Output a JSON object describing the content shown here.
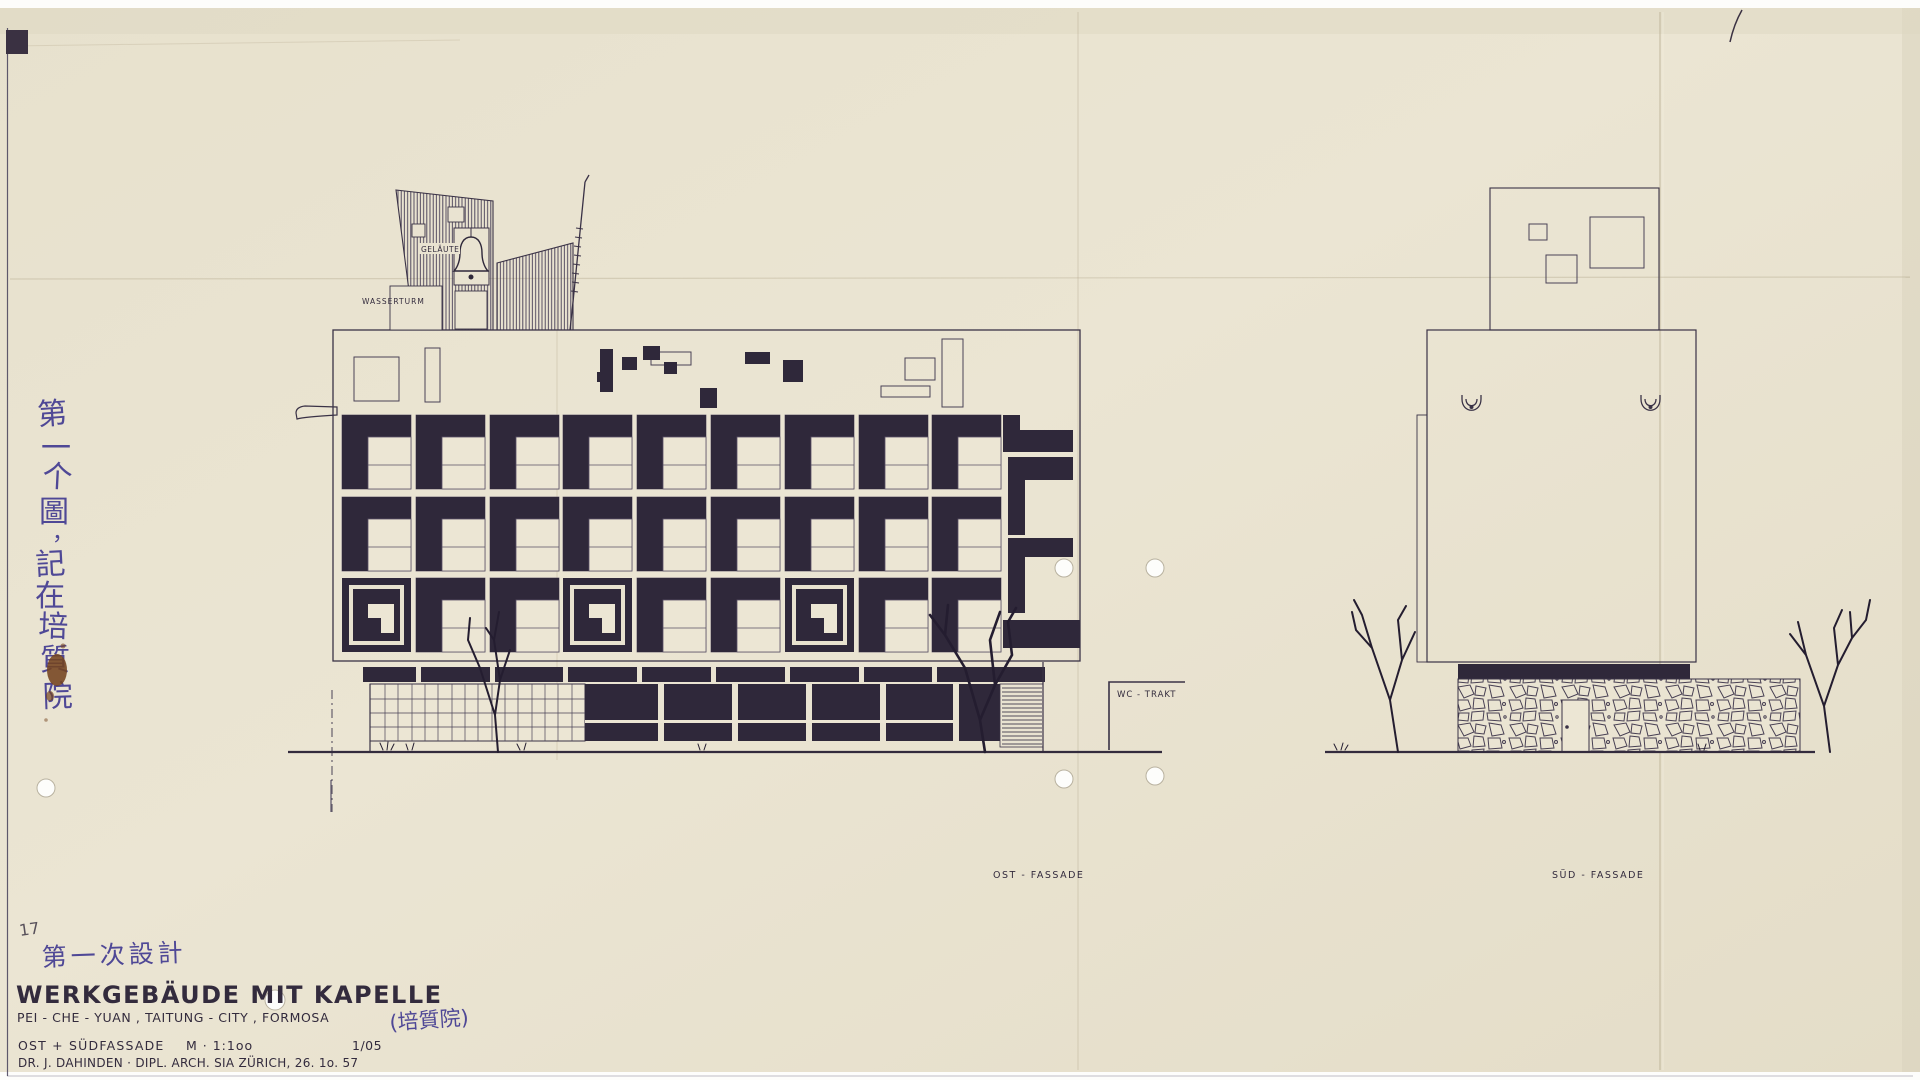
{
  "colors": {
    "paper": "#e9e3d1",
    "ink": "#332b3d",
    "black_fill": "#2f283a",
    "handwriting_blue": "#4f4896",
    "pencil_gray": "#8b84a8",
    "stain_rust": "#74431f"
  },
  "drawing_labels": {
    "gelaeute": "GELÄUTE",
    "wasserturm": "WASSERTURM",
    "wc_trakt": "WC - TRAKT",
    "ost_fassade": "OST - FASSADE",
    "sued_fassade": "SÜD - FASSADE"
  },
  "handwriting": {
    "margin_chars": [
      "第",
      "一",
      "个",
      "圖",
      "，",
      "記",
      "在",
      "培",
      "質",
      "院"
    ],
    "design_note": "第一次設計",
    "institute_name_cn": "(培質院)",
    "pencil_number": "17"
  },
  "title_block": {
    "title": "WERKGEBÄUDE MIT KAPELLE",
    "location_line": "PEI - CHE - YUAN , TAITUNG - CITY , FORMOSA",
    "views_label": "OST + SÜDFASSADE",
    "scale_label": "M · 1:1oo",
    "sheet_number": "1/05",
    "credit_line": "DR. J. DAHINDEN · DIPL. ARCH. SIA ZÜRICH, 26. 1o. 57"
  }
}
